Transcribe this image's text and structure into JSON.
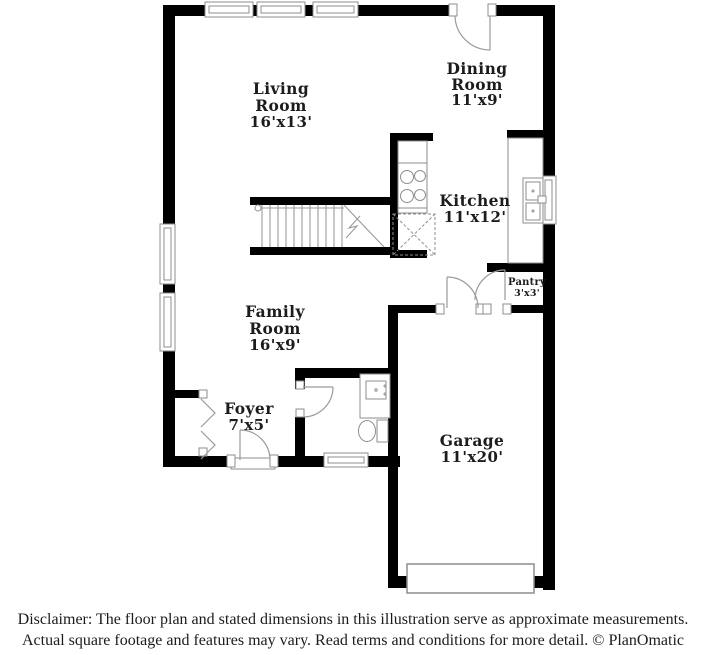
{
  "rooms": {
    "living": {
      "line1": "Living",
      "line2": "Room",
      "dims": "16'x13'"
    },
    "dining": {
      "line1": "Dining",
      "line2": "Room",
      "dims": "11'x9'"
    },
    "kitchen": {
      "name": "Kitchen",
      "dims": "11'x12'"
    },
    "pantry": {
      "name": "Pantry",
      "dims": "3'x3'"
    },
    "family": {
      "line1": "Family",
      "line2": "Room",
      "dims": "16'x9'"
    },
    "foyer": {
      "name": "Foyer",
      "dims": "7'x5'"
    },
    "garage": {
      "name": "Garage",
      "dims": "11'x20'"
    }
  },
  "footer": {
    "line1": "Disclaimer: The floor plan and stated dimensions in this illustration serve as approximate measurements.",
    "line2": "Actual square footage and features may vary. Read terms and conditions for more detail. © PlanOmatic"
  },
  "colors": {
    "wall": "#000000",
    "fixture_line": "#8e8e8e",
    "label_text": "#1c1c1c",
    "background": "#ffffff"
  }
}
